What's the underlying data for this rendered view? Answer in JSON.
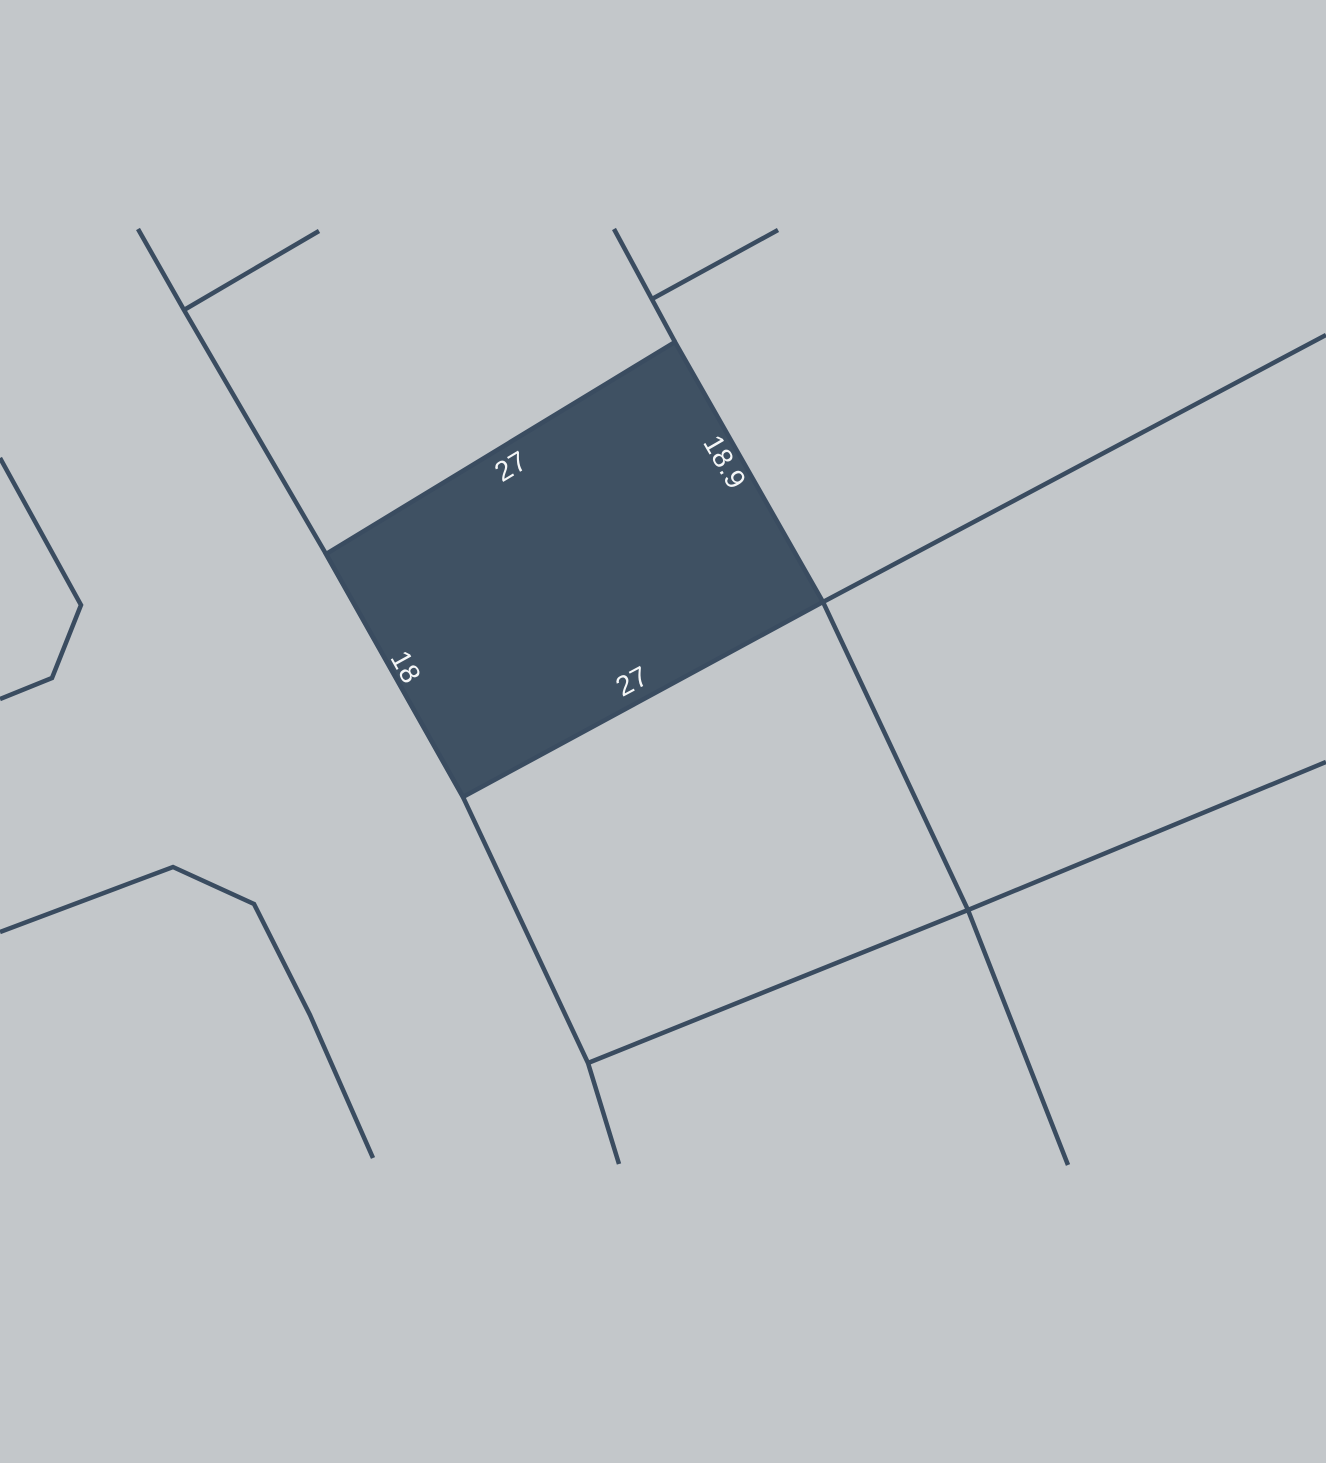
{
  "map": {
    "canvas": {
      "width": 1326,
      "height": 1463
    },
    "background_color": "#c3c7ca",
    "line_color": "#3a4c60",
    "line_width": 4.5,
    "boundary_lines": [
      {
        "name": "west-road",
        "points": "138,229 184,310 326,554 463,797 588,1063 619,1164"
      },
      {
        "name": "northwest-spur",
        "points": "184,310 319,231"
      },
      {
        "name": "north-branch",
        "points": "614,229 675,342"
      },
      {
        "name": "northeast-spur",
        "points": "652,299 778,230"
      },
      {
        "name": "east-road",
        "points": "1326,335 823,602 968,910 1068,1165"
      },
      {
        "name": "southeast-road",
        "points": "588,1063 968,910 1326,762"
      },
      {
        "name": "west-chevron",
        "points": "0,458 81,605 52,678 0,699"
      },
      {
        "name": "southwest-road",
        "points": "0,932 173,867 254,904 310,1015 373,1158"
      }
    ],
    "parcel": {
      "fill_color": "#3f5163",
      "points": "326,554 675,342 823,602 463,797",
      "label_color": "#f4f6f7",
      "label_font_size": 28,
      "dimension_labels": [
        {
          "edge": "north",
          "text": "27",
          "x": 512,
          "y": 468,
          "rotation": -31
        },
        {
          "edge": "east",
          "text": "18.9",
          "x": 723,
          "y": 463,
          "rotation": 60
        },
        {
          "edge": "west",
          "text": "18",
          "x": 404,
          "y": 668,
          "rotation": 61
        },
        {
          "edge": "south",
          "text": "27",
          "x": 633,
          "y": 683,
          "rotation": -28
        }
      ]
    }
  }
}
